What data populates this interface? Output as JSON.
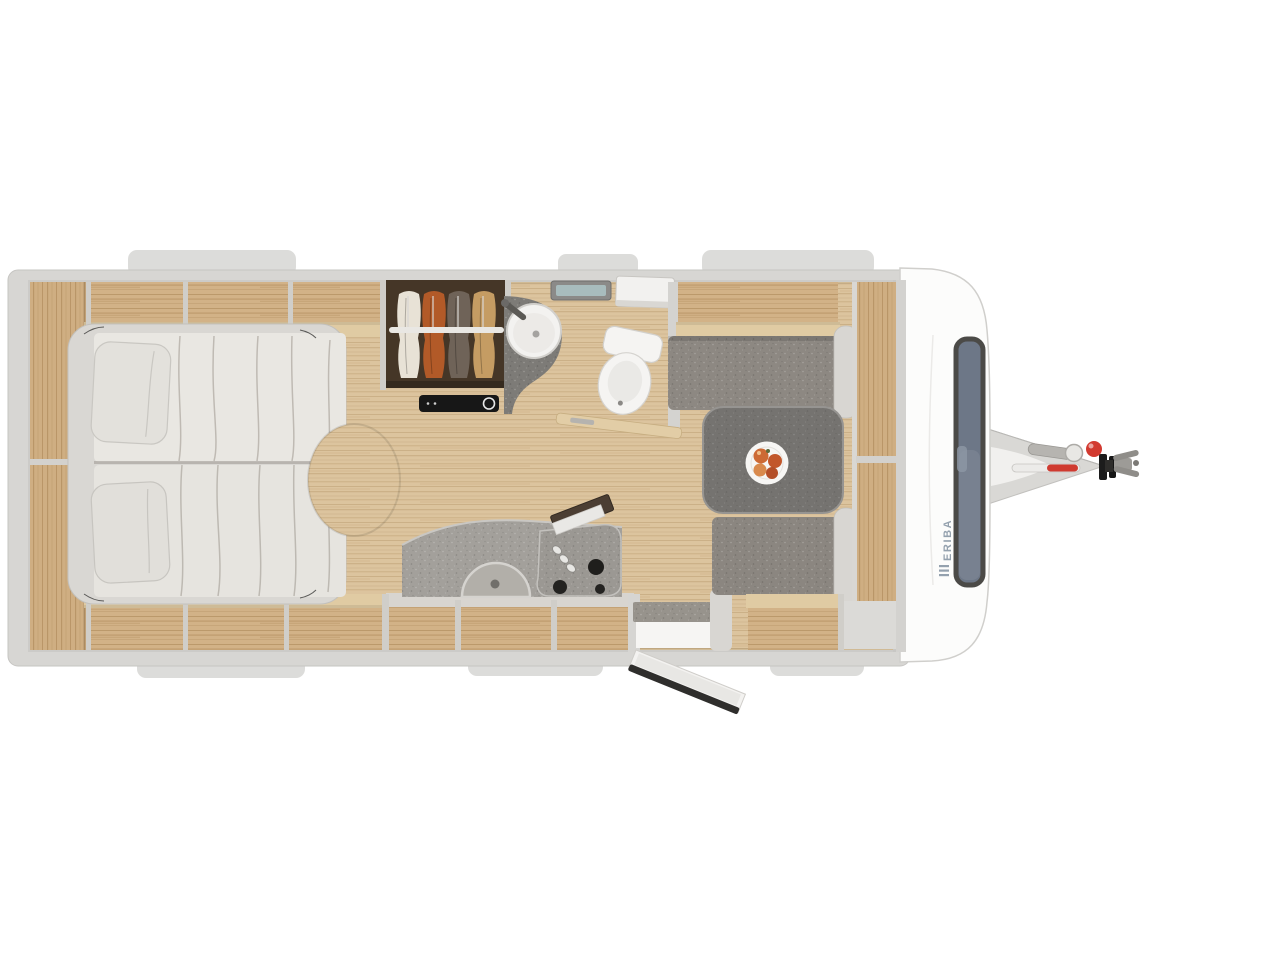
{
  "brand": {
    "label": "ERIBA"
  },
  "diagram": {
    "type": "caravan-floorplan-top-view",
    "areas": [
      "twin-beds",
      "pillows",
      "overhead-lockers",
      "side-shelf",
      "wardrobe-with-clothes",
      "heater-panel",
      "washroom-sink",
      "washroom-counter",
      "washroom-window",
      "overhead-cabinet",
      "toilet",
      "washroom-door",
      "kitchen-counter",
      "kitchen-sink",
      "gas-hob",
      "hob-knobs",
      "kitchen-lockers",
      "entry-door",
      "door-mat",
      "entry-step",
      "dinette-bench-left",
      "dinette-bench-right",
      "dinette-table",
      "fruit-plate",
      "front-sideboard",
      "front-window",
      "front-body",
      "drawbar",
      "jockey-wheel-handle",
      "breakaway-lever",
      "coupling-head",
      "exterior-skirt-tabs"
    ]
  },
  "palette": {
    "background": "#ffffff",
    "body_shell": "#fcfcfb",
    "wall_gray": "#d6d5d2",
    "floor_wood": "#dcc49e",
    "cabinet_wood": "#d2b287",
    "shelf_rail": "#e0cba3",
    "upholstery_gray": "#8d8882",
    "table_gray": "#757370",
    "counter_gray": "#a3a09b",
    "washroom_counter": "#7d7b77",
    "mattress_cream": "#e9e7e2",
    "wardrobe_interior": "#453627",
    "accent_red": "#d23a30",
    "logo_blue": "#93a0ad",
    "window_glass": "#6d7787"
  }
}
